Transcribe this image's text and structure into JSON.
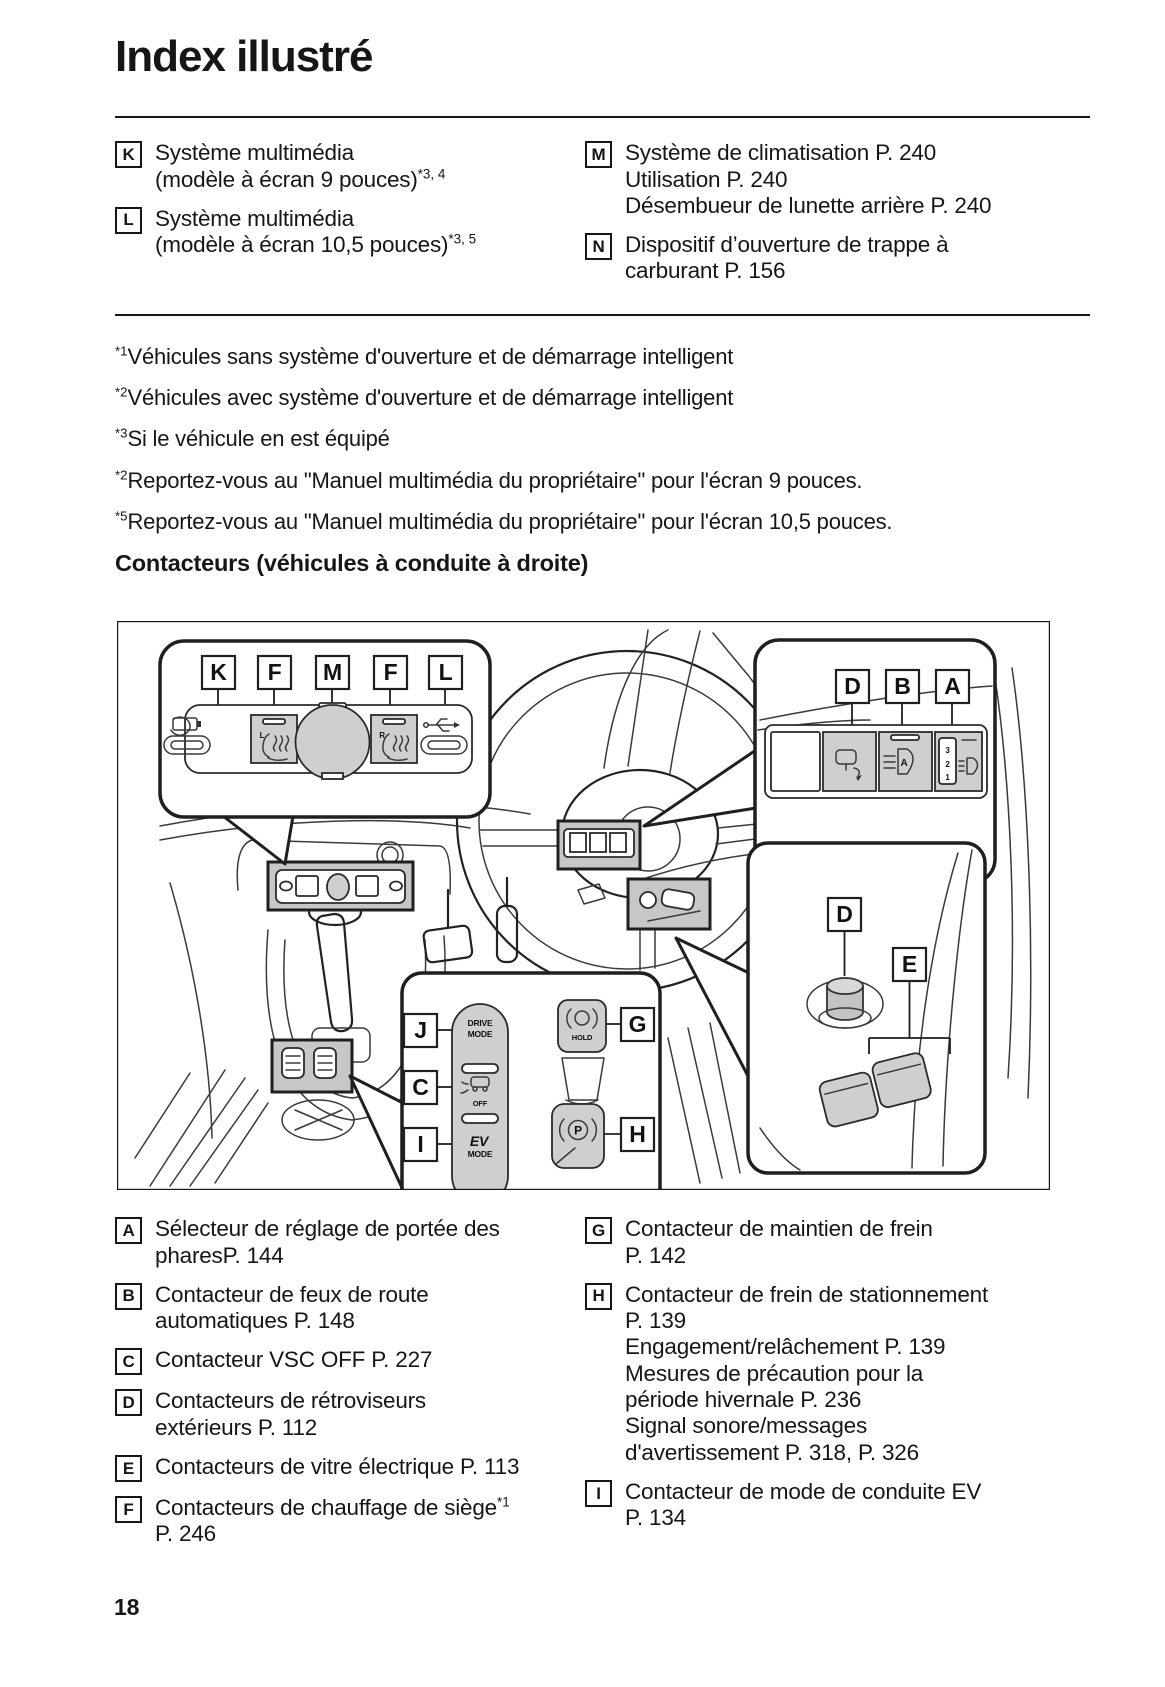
{
  "page": {
    "title": "Index illustré",
    "number": "18"
  },
  "top_list": {
    "left": [
      {
        "letter": "K",
        "text": "Système multimédia\n(modèle à écran 9 pouces)",
        "sup": "*3, 4"
      },
      {
        "letter": "L",
        "text": "Système multimédia\n(modèle à écran 10,5 pouces)",
        "sup": "*3, 5"
      }
    ],
    "right": [
      {
        "letter": "M",
        "text": "Système de climatisation P. 240\nUtilisation P. 240\nDésembueur de lunette arrière P. 240"
      },
      {
        "letter": "N",
        "text": "Dispositif d’ouverture de trappe à\ncarburant P. 156"
      }
    ]
  },
  "footnotes": [
    {
      "marker": "*1",
      "text": "Véhicules sans système d'ouverture et de démarrage intelligent"
    },
    {
      "marker": "*2",
      "text": "Véhicules avec système d'ouverture et de démarrage intelligent"
    },
    {
      "marker": "*3",
      "text": "Si le véhicule en est équipé"
    },
    {
      "marker": "*2",
      "text": "Reportez-vous au \"Manuel multimédia du propriétaire\" pour l'écran 9 pouces."
    },
    {
      "marker": "*5",
      "text": "Reportez-vous au \"Manuel multimédia du propriétaire\" pour l'écran 10,5 pouces."
    }
  ],
  "section_heading": "Contacteurs (véhicules à conduite à droite)",
  "diagram": {
    "tl_labels": [
      "K",
      "F",
      "M",
      "F",
      "L"
    ],
    "tr_labels": [
      "D",
      "B",
      "A"
    ],
    "bc_labels": [
      "J",
      "C",
      "I",
      "G",
      "H"
    ],
    "br_labels": [
      "D",
      "E"
    ],
    "seat_left": "L",
    "seat_right": "R",
    "dial_numbers": [
      "3",
      "2",
      "1"
    ],
    "auto_beam_letter": "A",
    "drive_mode_line1": "DRIVE",
    "drive_mode_line2": "MODE",
    "vsc_off": "OFF",
    "ev": "EV",
    "ev_mode": "MODE",
    "brake_hold": "HOLD",
    "parking": "P"
  },
  "legend": {
    "left": [
      {
        "letter": "A",
        "text": "Sélecteur de réglage de portée des\npharesP. 144"
      },
      {
        "letter": "B",
        "text": "Contacteur de feux de route\nautomatiques P. 148"
      },
      {
        "letter": "C",
        "text": "Contacteur VSC OFF P. 227"
      },
      {
        "letter": "D",
        "text": "Contacteurs de rétroviseurs\nextérieurs P. 112"
      },
      {
        "letter": "E",
        "text": "Contacteurs de vitre électrique P. 113"
      },
      {
        "letter": "F",
        "text": "Contacteurs de chauffage de siège",
        "sup": "*1",
        "text2": "\nP. 246"
      }
    ],
    "right": [
      {
        "letter": "G",
        "text": "Contacteur de maintien de frein\nP. 142"
      },
      {
        "letter": "H",
        "text": "Contacteur de frein de stationnement\nP. 139\nEngagement/relâchement P. 139\nMesures de précaution pour la\npériode hivernale P. 236\nSignal sonore/messages\nd'avertissement P. 318, P. 326"
      },
      {
        "letter": "I",
        "text": "Contacteur de mode de conduite EV\nP. 134"
      }
    ]
  }
}
